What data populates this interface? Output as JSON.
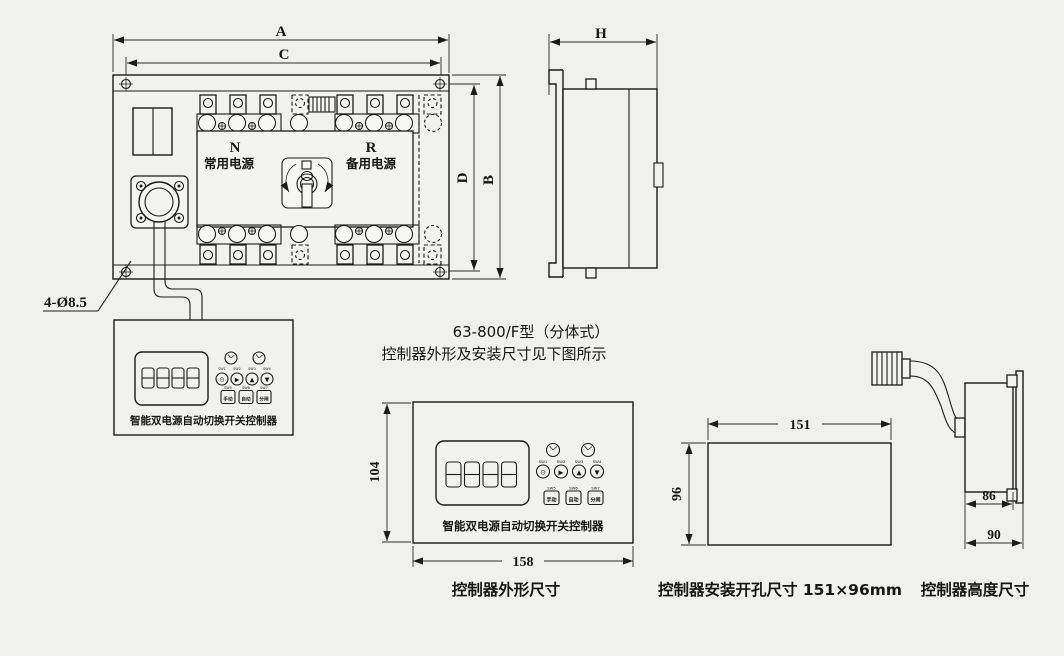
{
  "page": {
    "bg": "#f0f0ee",
    "ink": "#1b1b1b"
  },
  "front_view": {
    "dim_a": "A",
    "dim_c": "C",
    "dim_b": "B",
    "dim_d": "D",
    "pole_n": "N",
    "pole_n_label": "常用电源",
    "pole_r": "R",
    "pole_r_label": "备用电源",
    "hole_callout": "4-Ø8.5"
  },
  "side_view": {
    "dim_h": "H"
  },
  "controller": {
    "name": "智能双电源自动切换开关控制器",
    "display_digits": "8888",
    "indicator_icon": "clock-icon",
    "round_buttons": [
      {
        "label": "SW1",
        "glyph": "⊙"
      },
      {
        "label": "SW2",
        "glyph": "▶"
      },
      {
        "label": "SW3",
        "glyph": "▲"
      },
      {
        "label": "SW4",
        "glyph": "▼"
      }
    ],
    "square_buttons": [
      {
        "label": "SW5",
        "text": "手动"
      },
      {
        "label": "SW6",
        "text": "自动"
      },
      {
        "label": "SW7",
        "text": "分闸"
      }
    ]
  },
  "note": {
    "line1": "63-800/F型（分体式）",
    "line2": "控制器外形及安装尺寸见下图所示"
  },
  "outline_drawing": {
    "height": "104",
    "width": "158",
    "caption": "控制器外形尺寸"
  },
  "cutout_drawing": {
    "width": "151",
    "height": "96",
    "caption": "控制器安装开孔尺寸 151×96mm"
  },
  "height_drawing": {
    "dim_inner": "86",
    "dim_outer": "90",
    "caption": "控制器高度尺寸"
  }
}
